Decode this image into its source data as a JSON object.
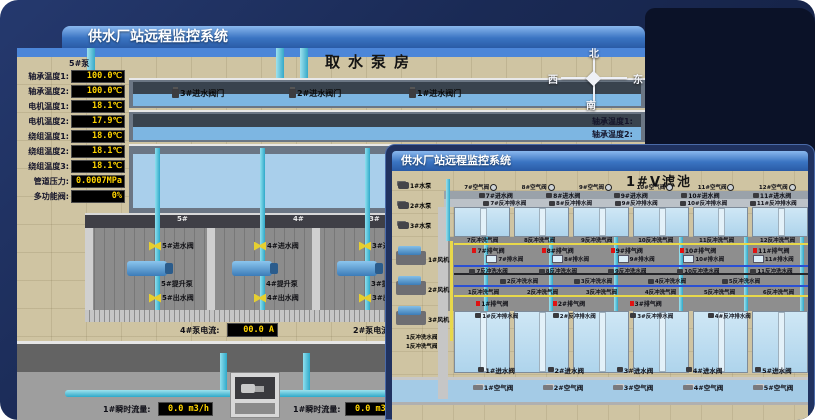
{
  "colors": {
    "desktop_navy": "#16234a",
    "titlebar_blue": "#2d62ae",
    "readout_text": "#ffd400",
    "valve_yellow": "#e6cf30",
    "pipe_cyan": "#35c3e0",
    "alarm_red": "#e01212",
    "water_blue": "#7db6e2",
    "floor_tan": "#cfc4a2"
  },
  "icons": {
    "compass": "compass-rose",
    "gear": "gear-circle",
    "valve": "bowtie-valve",
    "flag": "red-flag",
    "tank": "drain-tank",
    "pump": "pump-body",
    "blower": "blower-unit",
    "flowmeter": "flowmeter-box"
  },
  "back_window": {
    "title": "供水厂站远程监控系统",
    "scene_title": "取水泵房",
    "pump_panel": {
      "header": "5#泵",
      "rows": [
        {
          "label": "轴承温度1:",
          "value": "100.0℃"
        },
        {
          "label": "轴承温度2:",
          "value": "100.0℃"
        },
        {
          "label": "电机温度1:",
          "value": "18.1℃"
        },
        {
          "label": "电机温度2:",
          "value": "17.9℃"
        },
        {
          "label": "绕组温度1:",
          "value": "18.0℃"
        },
        {
          "label": "绕组温度2:",
          "value": "18.1℃"
        },
        {
          "label": "绕组温度3:",
          "value": "18.1℃"
        },
        {
          "label": "管道压力:",
          "value": "0.0007MPa"
        },
        {
          "label": "多功能阀:",
          "value": "0%"
        }
      ]
    },
    "inlet_valves": [
      "3#进水阀门",
      "2#进水阀门",
      "1#进水阀门"
    ],
    "compass": {
      "n": "北",
      "w": "西",
      "s": "南",
      "e": "东"
    },
    "right_panel_partial": [
      "轴承温度1:",
      "轴承温度2:"
    ],
    "bays": [
      {
        "no": "5#",
        "inlet": "5#进水阀",
        "pump": "5#提升泵",
        "outlet": "5#出水阀"
      },
      {
        "no": "4#",
        "inlet": "4#进水阀",
        "pump": "4#提升泵",
        "outlet": "4#出水阀"
      },
      {
        "no": "3#",
        "inlet": "3#进水阀",
        "pump": "3#提升泵",
        "outlet": "3#出水阀"
      }
    ],
    "current_readouts": [
      {
        "label": "4#泵电流:",
        "value": "00.0 A"
      },
      {
        "label": "2#泵电流:",
        "value": ""
      }
    ],
    "flow_readouts": [
      {
        "label": "1#瞬时流量:",
        "value": "0.0 m3/h"
      },
      {
        "label": "1#瞬时流量:",
        "value": "0.0 m3/h"
      }
    ]
  },
  "front_window": {
    "title": "供水厂站远程监控系统",
    "scene_title": "1#V滤池",
    "pumps": [
      "1#水泵",
      "2#水泵",
      "3#水泵"
    ],
    "blowers": [
      "1#风机",
      "2#风机",
      "3#风机"
    ],
    "left_labels": [
      "1反冲洗水阀",
      "1反冲洗气阀"
    ],
    "top_air_valves": [
      "7#空气阀",
      "8#空气阀",
      "9#空气阀",
      "10#空气阀",
      "11#空气阀",
      "12#空气阀"
    ],
    "top_inlet_valves": [
      "7#进水阀",
      "8#进水阀",
      "9#进水阀",
      "10#进水阀",
      "11#进水阀"
    ],
    "top_bw_drain": [
      "7#反冲排水阀",
      "8#反冲排水阀",
      "9#反冲排水阀",
      "10#反冲排水阀",
      "11#反冲排水阀"
    ],
    "mid_bw_air_top": [
      "7反冲洗气阀",
      "8反冲洗气阀",
      "9反冲洗气阀",
      "10反冲洗气阀",
      "11反冲洗气阀",
      "12反冲洗气阀"
    ],
    "mid_exhaust_top": [
      "7#排气阀",
      "8#排气阀",
      "9#排气阀",
      "10#排气阀",
      "11#排气阀"
    ],
    "mid_drain_top": [
      "7#排水阀",
      "8#排水阀",
      "9#排水阀",
      "10#排水阀",
      "11#排水阀"
    ],
    "mid_bw_water_top": [
      "7反冲洗水阀",
      "8反冲洗水阀",
      "9反冲洗水阀",
      "10反冲洗水阀",
      "11反冲洗水阀"
    ],
    "mid_bw_water_bottom": [
      "2反冲洗水阀",
      "3反冲洗水阀",
      "4反冲洗水阀",
      "5反冲洗水阀"
    ],
    "mid_bw_air_bottom": [
      "1反冲洗气阀",
      "2反冲洗气阀",
      "3反冲洗气阀",
      "4反冲洗气阀",
      "5反冲洗气阀",
      "6反冲洗气阀"
    ],
    "mid_exhaust_bottom": [
      "1#排气阀",
      "2#排气阀",
      "3#排气阀"
    ],
    "bottom_bw_drain": [
      "1#反冲排水阀",
      "2#反冲排水阀",
      "3#反冲排水阀",
      "4#反冲排水阀"
    ],
    "bottom_inlet_valves": [
      "1#进水阀",
      "2#进水阀",
      "3#进水阀",
      "4#进水阀",
      "5#进水阀"
    ],
    "bottom_air_valves": [
      "1#空气阀",
      "2#空气阀",
      "3#空气阀",
      "4#空气阀",
      "5#空气阀"
    ]
  }
}
